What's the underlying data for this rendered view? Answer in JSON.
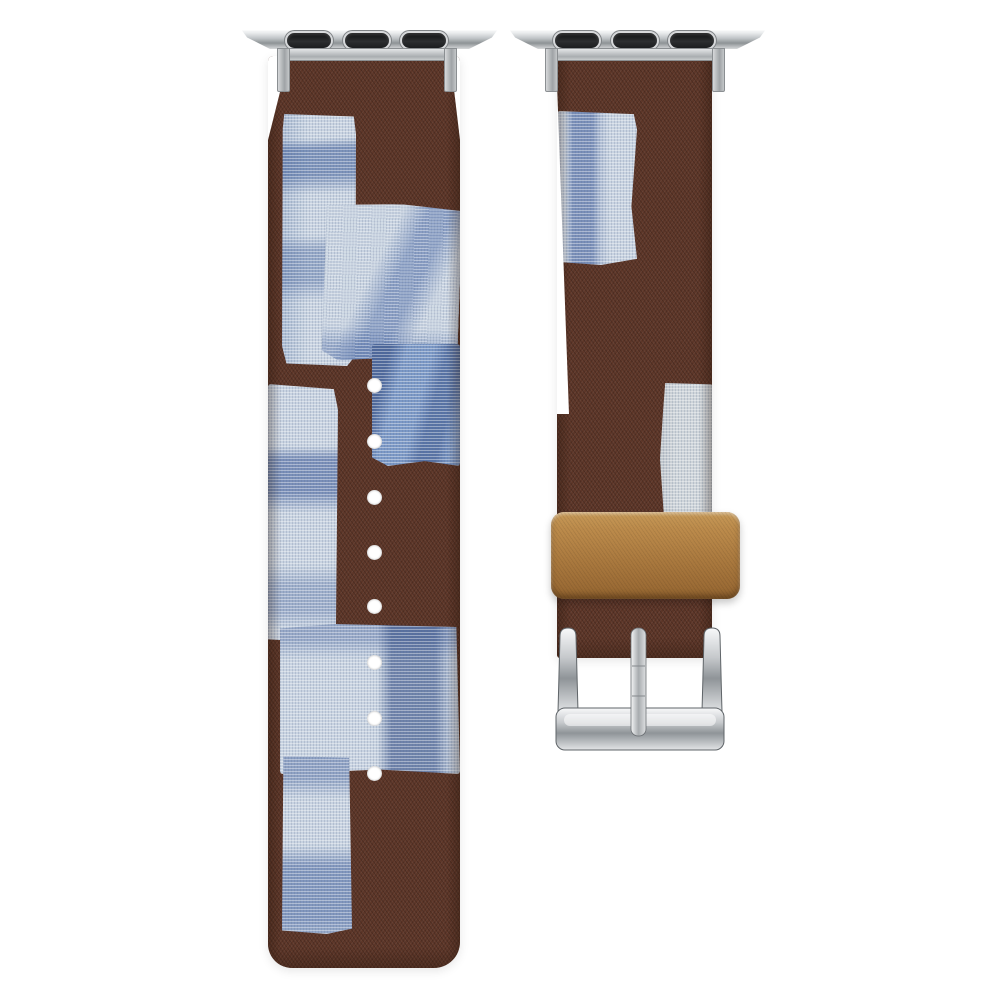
{
  "background_color": "#ffffff",
  "scene_description": "Two-piece watch band photographed on white: left long strap with round adjustment holes, right buckle strap with tan leather keeper loop and polished silver square buckle; both pieces are brown fabric with indigo shibori-dyed canvas patchwork and silver watch-lug adapters at the top",
  "colors": {
    "background": "#ffffff",
    "brown": "#5d3628",
    "brown_dark": "#452a1d",
    "canvas_light_blue": "#c8d3e1",
    "canvas_medium_blue": "#7b98c6",
    "canvas_indigo": "#3c5c9a",
    "patch_grey": "#cfd5da",
    "keeper_tan": "#ab7a3f",
    "keeper_tan_light": "#c79a58",
    "silver_light": "#f5f6f7",
    "silver_mid": "#b9bdc0",
    "silver_dark": "#82878b",
    "slot_black": "#1b1d1f",
    "hole_white": "#ffffff"
  },
  "left_strap": {
    "adjustment_holes": {
      "count": 8,
      "center_x": 374,
      "centers_y": [
        385,
        441,
        497,
        552,
        606,
        662,
        718,
        773
      ],
      "diameter": 15
    }
  },
  "right_strap": {
    "keeper_loops": 1,
    "buckle_prongs": 1
  },
  "adapters": {
    "count": 2,
    "slots_per_adapter": 3
  }
}
